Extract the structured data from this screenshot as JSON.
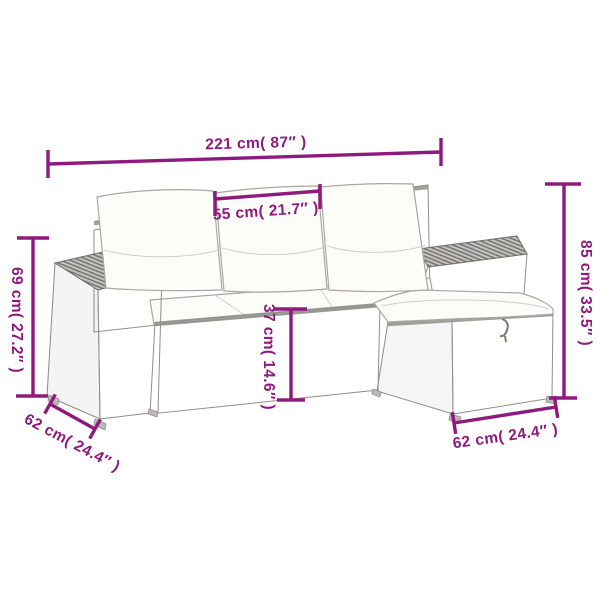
{
  "dimensions": {
    "total_width": "221 cm( 87″ )",
    "middle_seat_width": "55 cm( 21.7″ )",
    "total_height": "85 cm( 33.5″ )",
    "armrest_height": "69 cm( 27.2″ )",
    "seat_height": "37 cm( 14.6″ )",
    "left_depth": "62 cm( 24.4″ )",
    "footstool_depth": "62 cm( 24.4″ )"
  },
  "colors": {
    "dimension_accent": "#8e1a7e",
    "rattan_light": "#dfdedb",
    "rattan_weave": "#a9a8a4",
    "rattan_top": "#c7c6c2",
    "cushion_white": "#fcfcf9",
    "background": "#ffffff"
  }
}
